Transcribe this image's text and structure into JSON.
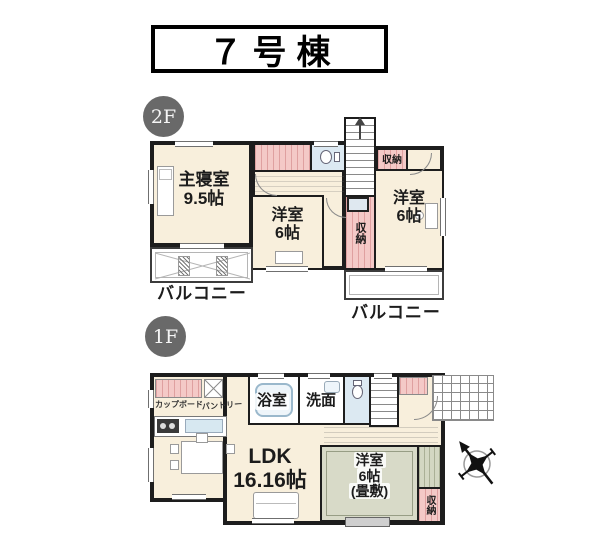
{
  "title": "７号棟",
  "floor2": {
    "badge": "2F",
    "master_name": "主寝室",
    "master_size": "9.5帖",
    "west_mid_name": "洋室",
    "west_mid_size": "6帖",
    "west_right_name": "洋室",
    "west_right_size": "6帖",
    "storage_top": "収納",
    "storage_mid": "収納",
    "balcony_left": "バルコニー",
    "balcony_right": "バルコニー"
  },
  "floor1": {
    "badge": "1F",
    "cupboard": "カップボード",
    "pantry": "パントリー",
    "bath": "浴室",
    "wash": "洗面",
    "ldk_name": "LDK",
    "ldk_size": "16.16帖",
    "tatami_name": "洋室",
    "tatami_size": "6帖",
    "tatami_note": "(畳敷)",
    "storage": "収納"
  },
  "icons": {
    "compass": "compass-rose",
    "stairs_up": "up-arrow"
  },
  "colors": {
    "wall": "#1d1d1d",
    "floor_cream": "#f8efdc",
    "closet_pink": "#f4c9c7",
    "water_blue": "#dce9f2",
    "tatami_green": "#d8dac8",
    "badge_gray": "#696969"
  }
}
